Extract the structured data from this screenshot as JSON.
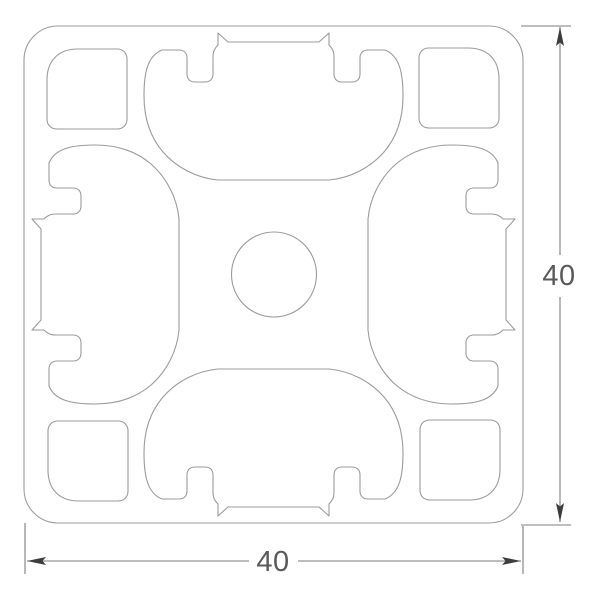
{
  "dimensions": {
    "height_label": "40",
    "width_label": "40"
  },
  "colors": {
    "background": "#ffffff",
    "profile_line": "#9b9b9b",
    "dimension_line": "#7d7d7d",
    "arrow": "#3d3d3d",
    "label_text": "#5a5a5a"
  }
}
